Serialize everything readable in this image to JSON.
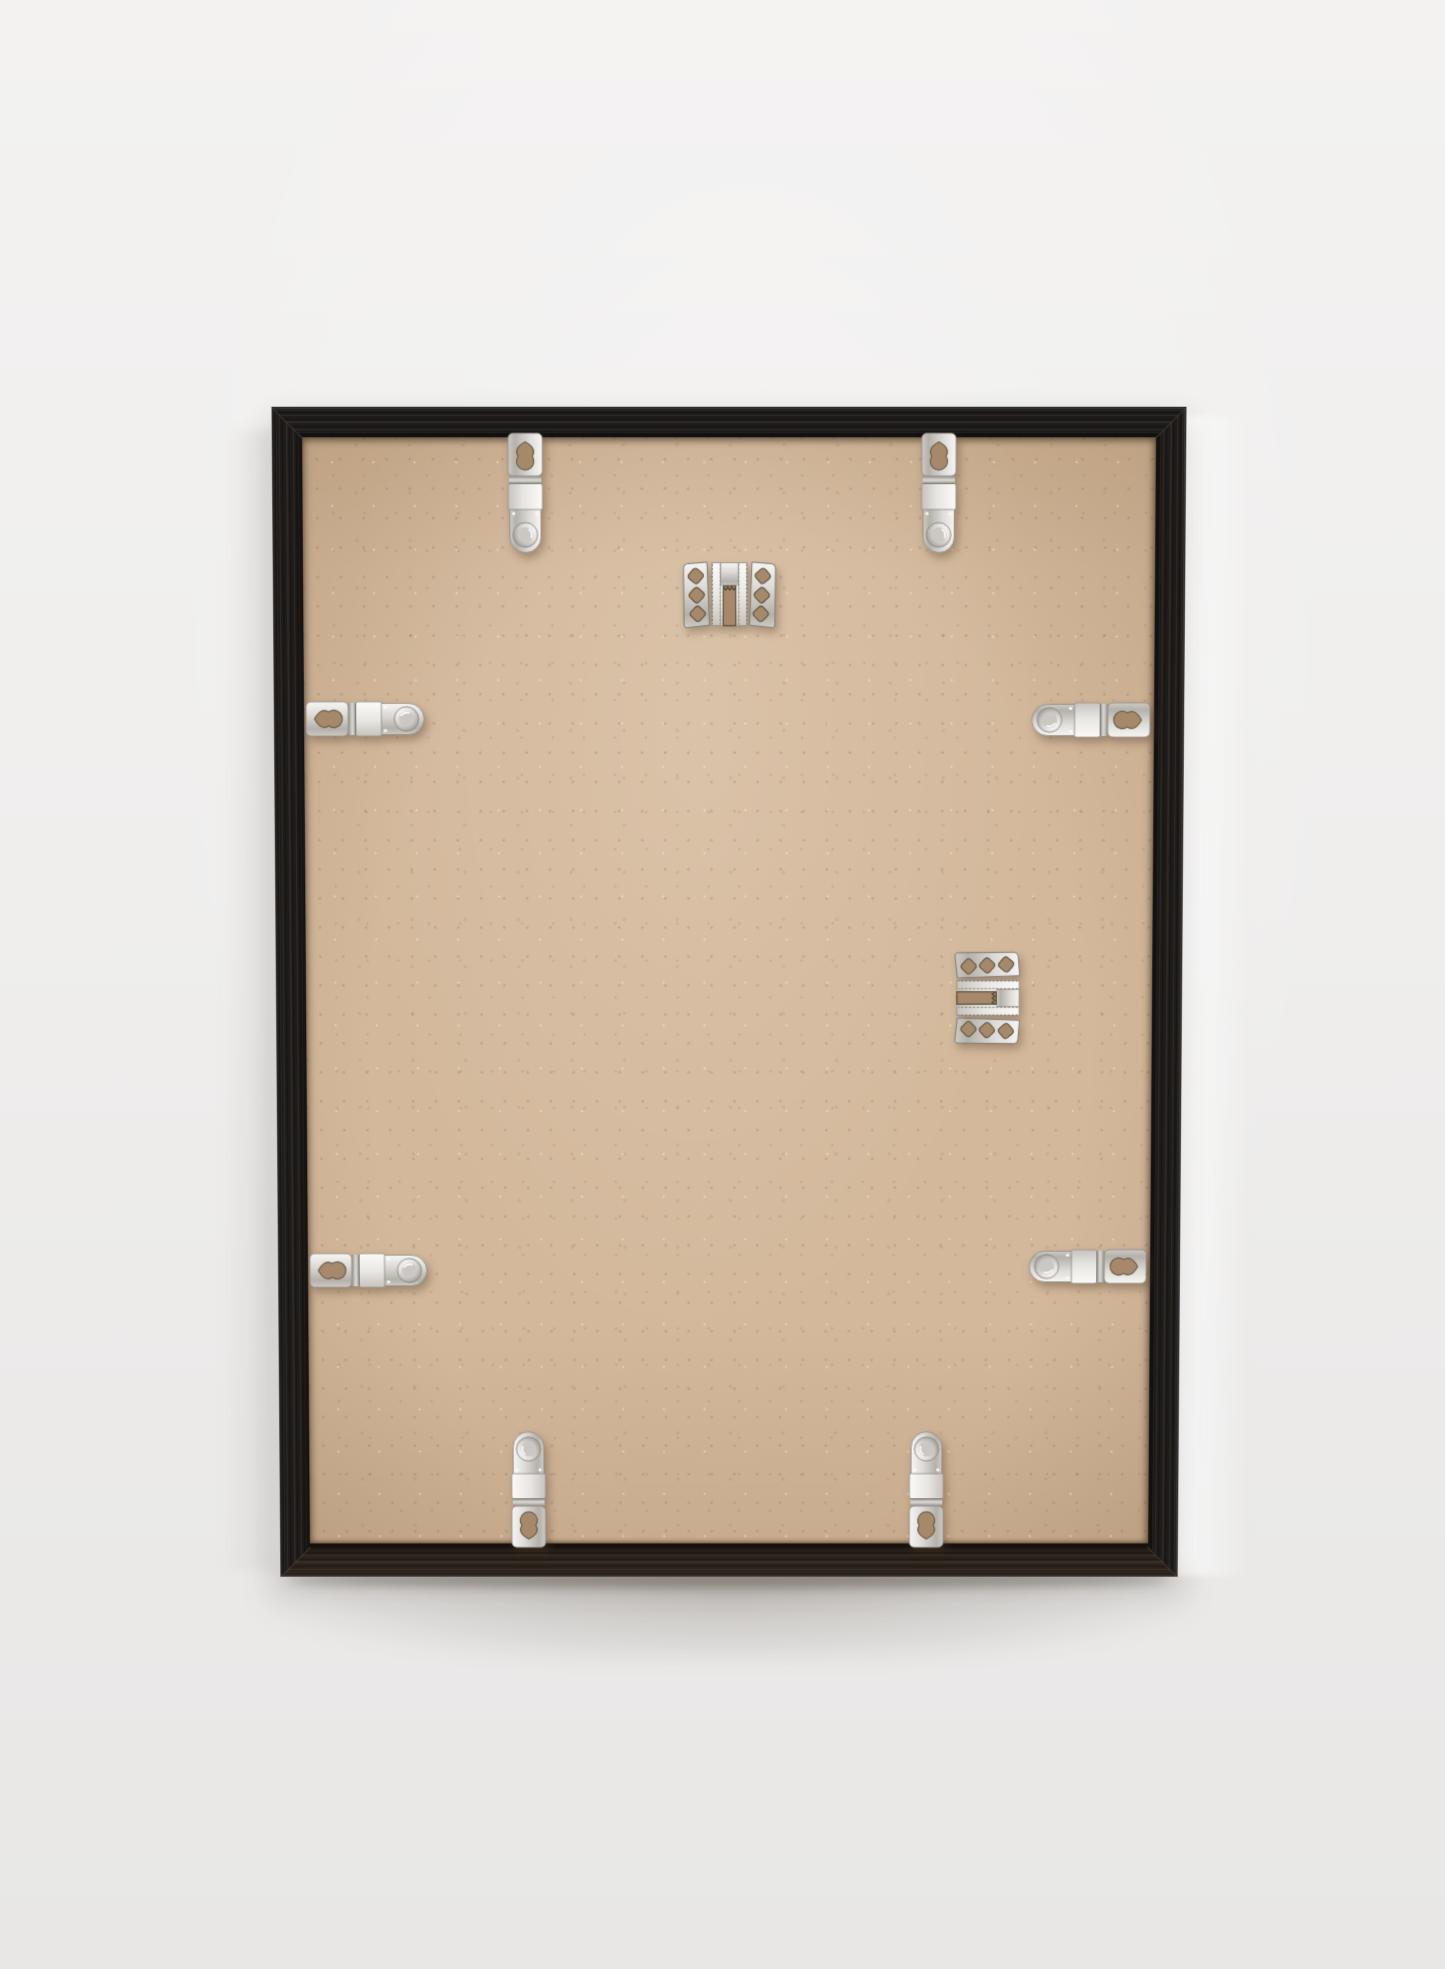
{
  "meta": {
    "type": "photograph",
    "subject": "back of a black wooden picture frame leaning against a light grey wall"
  },
  "palette": {
    "bg-top": "#f3f2f1",
    "bg-mid": "#efeeed",
    "bg-bottom": "#e8e7e6",
    "wood": "#1e1b19",
    "wood-hi": "#45403b",
    "wood-bottom": "#2a221b",
    "board": "#d3b89b",
    "board-edge": "#c4a784",
    "hole": "#a5896a",
    "metal-light": "#f6f5f3",
    "metal-mid": "#cecbc6",
    "metal-dark": "#8e8b85",
    "shadow-warm": "rgba(77,55,34,0.38)"
  },
  "frame": {
    "aria_scene": "Product photograph of the back of a picture frame",
    "aria_frame": "Black wood picture frame seen from the back",
    "aria_board": "Kraft MDF backing board",
    "aria_clip": "Flexible metal retaining clip",
    "aria_hanger": "Metal hanging bracket with serrated slot",
    "clips_count": 8,
    "hangers_count": 2
  },
  "hardware": {
    "clips": [
      {
        "id": "top-left",
        "side": "top"
      },
      {
        "id": "top-right",
        "side": "top"
      },
      {
        "id": "right-upper",
        "side": "right"
      },
      {
        "id": "right-lower",
        "side": "right"
      },
      {
        "id": "bottom-left",
        "side": "bottom"
      },
      {
        "id": "bottom-right",
        "side": "bottom"
      },
      {
        "id": "left-upper",
        "side": "left"
      },
      {
        "id": "left-lower",
        "side": "left"
      }
    ],
    "hangers": [
      {
        "id": "top-center",
        "notch_direction": "down"
      },
      {
        "id": "middle-right",
        "notch_direction": "left"
      }
    ]
  }
}
